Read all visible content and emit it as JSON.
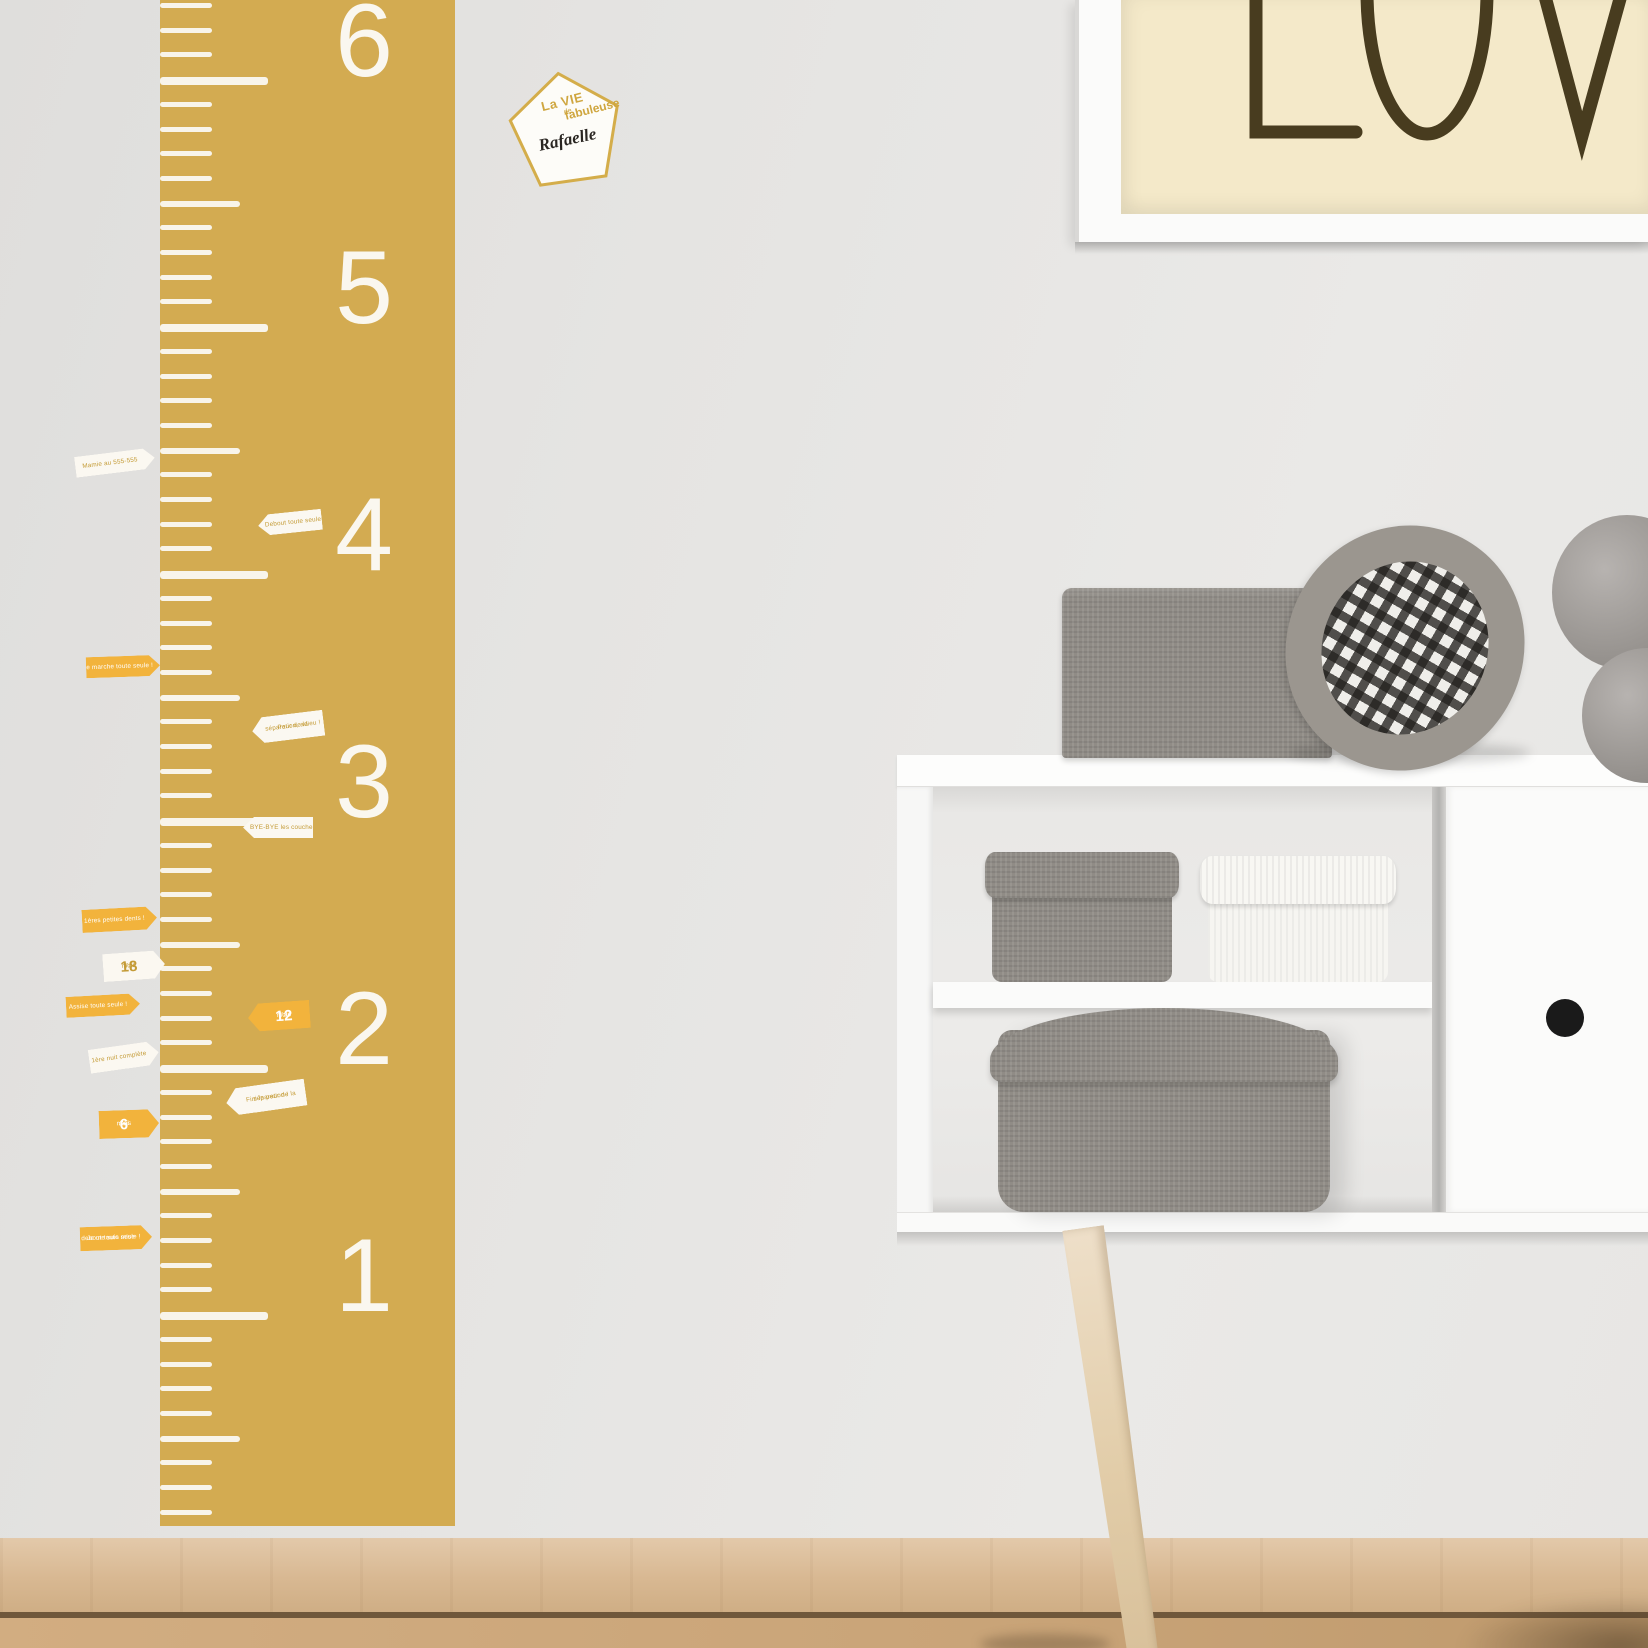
{
  "wall": {
    "color": "#e6e5e3"
  },
  "poster": {
    "visible_text": "LOV",
    "background": "#f4e9c9",
    "letter_color": "#483c1f",
    "frame_color": "#fbfbfa"
  },
  "ruler": {
    "color": "#d3ab51",
    "tick_color": "#f8f4ea",
    "numbers": [
      "6",
      "5",
      "4",
      "3",
      "2",
      "1"
    ]
  },
  "name_sticker": {
    "line1": "La VIE",
    "line2": "fabuleuse",
    "line3": "de",
    "name": "Rafaelle",
    "border_color": "#d4ad4a",
    "text_gold": "#cfa63f",
    "name_color": "#2a2622"
  },
  "milestones": {
    "flag_yellow": "#f2b33c",
    "flag_white": "#fbf8f1",
    "text_gold": "#c49b36",
    "text_white": "#ffffff",
    "items": [
      {
        "x": 75,
        "y": 452,
        "w": 80,
        "h": 21,
        "dir": "right",
        "style": "white",
        "rot": -7,
        "lines": [
          "Mamie au 555-555"
        ]
      },
      {
        "x": 258,
        "y": 512,
        "w": 64,
        "h": 21,
        "dir": "left",
        "style": "white",
        "rot": -6,
        "lines": [
          "Debout toute seule !"
        ]
      },
      {
        "x": 86,
        "y": 656,
        "w": 74,
        "h": 21,
        "dir": "right",
        "style": "yellow",
        "rot": -2,
        "lines": [
          "Je marche toute seule !"
        ]
      },
      {
        "x": 252,
        "y": 714,
        "w": 72,
        "h": 26,
        "dir": "left",
        "style": "white",
        "rot": -7,
        "lines": [
          "Peur de la",
          "séparation, adieu !"
        ]
      },
      {
        "x": 243,
        "y": 817,
        "w": 70,
        "h": 21,
        "dir": "left",
        "style": "white",
        "rot": 0,
        "lines": [
          "BYE-BYE les couches"
        ]
      },
      {
        "x": 82,
        "y": 908,
        "w": 75,
        "h": 23,
        "dir": "right",
        "style": "yellow",
        "rot": -3,
        "lines": [
          "1ères petites dents !"
        ]
      },
      {
        "x": 103,
        "y": 952,
        "w": 62,
        "h": 28,
        "dir": "right",
        "style": "white",
        "rot": -4,
        "pre": "J'ai",
        "big": "18",
        "post": "mois"
      },
      {
        "x": 66,
        "y": 995,
        "w": 74,
        "h": 21,
        "dir": "right",
        "style": "yellow",
        "rot": -3,
        "lines": [
          "Assise toute seule !"
        ]
      },
      {
        "x": 248,
        "y": 1002,
        "w": 62,
        "h": 28,
        "dir": "left",
        "style": "yellow",
        "rot": -4,
        "pre": "J'ai",
        "big": "12",
        "post": "mois"
      },
      {
        "x": 89,
        "y": 1045,
        "w": 70,
        "h": 24,
        "dir": "right",
        "style": "white",
        "rot": -8,
        "lines": [
          "1ère nuit complète"
        ]
      },
      {
        "x": 226,
        "y": 1084,
        "w": 80,
        "h": 27,
        "dir": "left",
        "style": "white",
        "rot": -8,
        "lines": [
          "Fini la peur de la",
          "séparation !"
        ]
      },
      {
        "x": 99,
        "y": 1110,
        "w": 60,
        "h": 28,
        "dir": "right",
        "style": "yellow",
        "rot": -2,
        "pre": "J'ai",
        "big": "6",
        "post": "mois"
      },
      {
        "x": 80,
        "y": 1226,
        "w": 72,
        "h": 24,
        "dir": "right",
        "style": "yellow",
        "rot": -2,
        "lines": [
          "Je me suis mise",
          "debout toute seule !"
        ]
      }
    ]
  },
  "furniture": {
    "body_color": "#fbfbfa",
    "knob_color": "#1a1a1a",
    "box_gray": "#908c86",
    "box_white": "#f6f5f1",
    "leg_wood": "#e6d3b8"
  },
  "floor": {
    "baseboard": "#dcc0a0",
    "floor": "#cda87d",
    "seam": "#7a5f42"
  }
}
